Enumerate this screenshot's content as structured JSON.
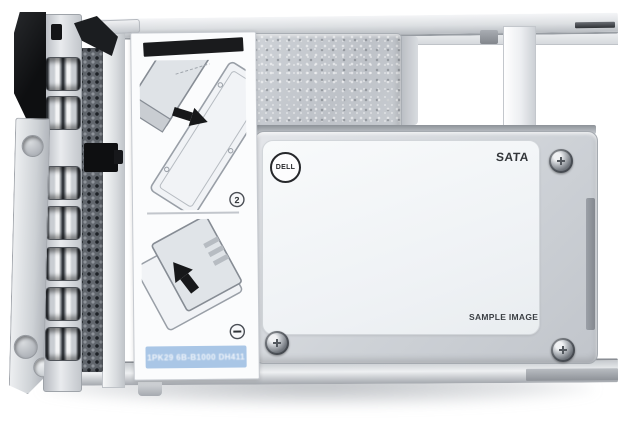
{
  "product": {
    "dell_logo": "DELL",
    "interface_label": "SATA",
    "watermark": "SAMPLE IMAGE"
  },
  "instruction_label": {
    "step_badge_upper": "2",
    "part_number": "1PK29 6B-B1000 DH411"
  },
  "colors": {
    "background": "#FFFFFF",
    "metal_silver": "#CDD1D6",
    "label_black": "#1A1B1D",
    "banner_blue": "#A9C6E6",
    "logo_dark": "#26282B"
  }
}
